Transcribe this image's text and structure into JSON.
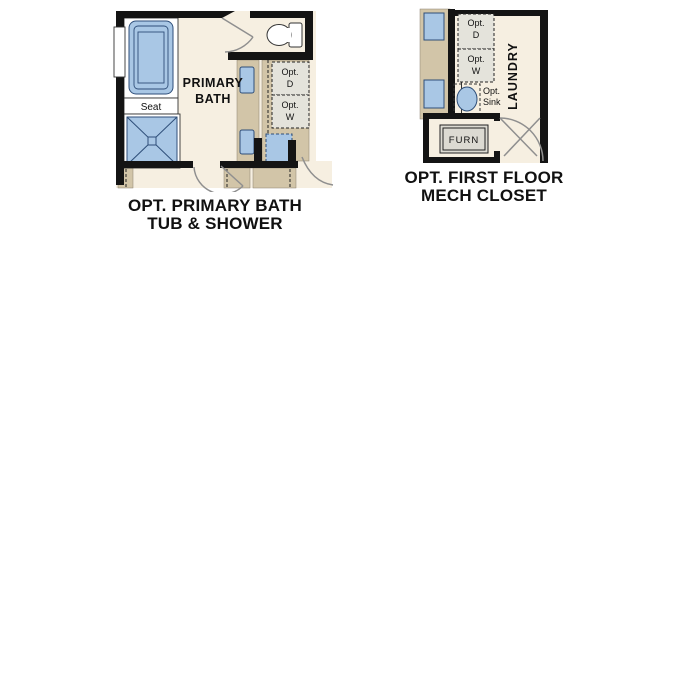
{
  "plans": {
    "primary_bath": {
      "title_line1": "OPT. PRIMARY BATH",
      "title_line2": "TUB & SHOWER",
      "room_line1": "PRIMARY",
      "room_line2": "BATH",
      "seat": "Seat",
      "dryer_line1": "Opt.",
      "dryer_line2": "D",
      "washer_line1": "Opt.",
      "washer_line2": "W"
    },
    "mech_closet": {
      "title_line1": "OPT. FIRST FLOOR",
      "title_line2": "MECH CLOSET",
      "laundry": "LAUNDRY",
      "dryer_line1": "Opt.",
      "dryer_line2": "D",
      "washer_line1": "Opt.",
      "washer_line2": "W",
      "sink_line1": "Opt.",
      "sink_line2": "Sink",
      "furnace": "FURN"
    }
  },
  "colors": {
    "wall_black": "#141414",
    "floor_cream": "#f6efe1",
    "wall_tan": "#d2c5a8",
    "fixture_blue": "#a9c7e5",
    "fixture_outline": "#2e4e79",
    "appliance_gray": "#e4e3db",
    "door_swing_gray": "#8f8f8f",
    "text": "#111111"
  }
}
